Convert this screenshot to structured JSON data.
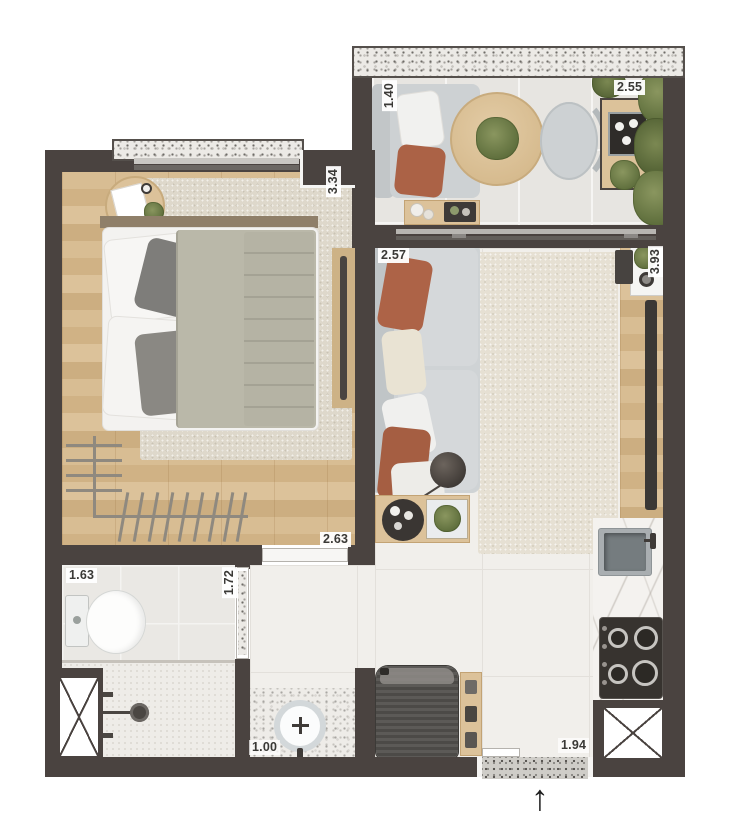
{
  "plan": {
    "type": "studio-apartment-floor-plan",
    "dimension_labels": {
      "balcony_depth": "1.40",
      "balcony_width": "2.55",
      "bedroom_depth": "3.34",
      "living_width": "2.57",
      "living_depth": "3.93",
      "bedroom_width": "2.63",
      "bathroom_width": "1.63",
      "bathroom_depth": "1.72",
      "washbasin_width": "1.00",
      "entry_width": "1.94"
    },
    "icons": {
      "north_arrow": "↑"
    },
    "colors": {
      "wall": "#4a4340",
      "wood_floor": "#d6ba8f",
      "tile_floor": "#f1efeb",
      "terracotta_accent": "#ad6347",
      "sofa_gray": "#cfd3d5",
      "greenery": "#687947",
      "granite_speckle": "#eceae6",
      "marble_counter": "#f4f2ef"
    }
  }
}
